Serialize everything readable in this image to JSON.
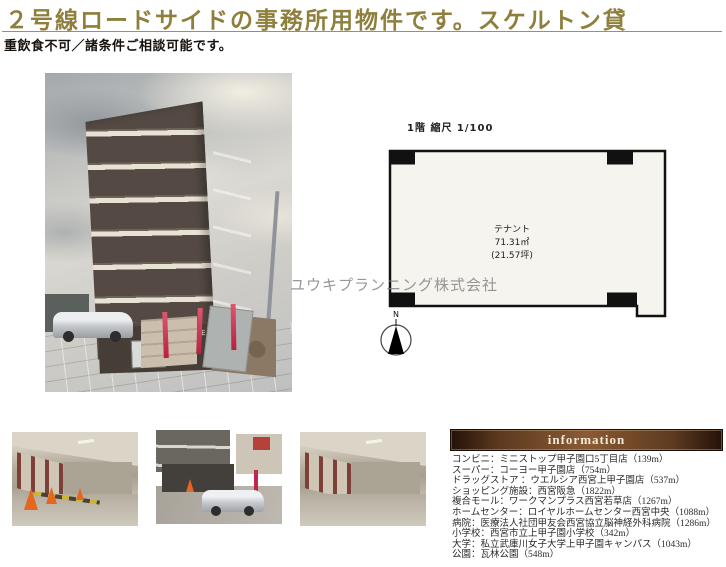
{
  "header": {
    "title": "２号線ロードサイドの事務所用物件です。スケルトン貸",
    "subtitle": "重飲食不可／諸条件ご相談可能です。"
  },
  "floor_plan": {
    "label": "1階 縮尺 1/100",
    "room_name": "テナント",
    "area_sqm": "71.31㎡",
    "area_tsubo": "(21.57坪)",
    "compass_label": "N"
  },
  "photos": {
    "building_sign": "RUSE 918"
  },
  "watermark": "ユウキプランニング株式会社",
  "information": {
    "heading": "information",
    "items": [
      "コンビニ：ミニストップ甲子園口5丁目店（139m）",
      "スーパー：コーヨー甲子園店（754m）",
      "ドラッグストア ：ウエルシア西宮上甲子園店（537m）",
      "ショッピング施設：西宮阪急（1822m）",
      "複合モール：ワークマンプラス西宮若草店（1267m）",
      "ホームセンター：ロイヤルホームセンター西宮中央（1088m）",
      "病院：医療法人社団甲友会西宮協立脳神経外科病院（1286m）",
      "小学校：西宮市立上甲子園小学校（342m）",
      "大学：私立武庫川女子大学上甲子園キャンパス（1043m）",
      "公園：瓦林公園（548m）"
    ]
  },
  "colors": {
    "title_gold": "#8e7f3c",
    "info_bar_dark": "#241208",
    "info_bar_light": "#8a5a33",
    "info_bar_text": "#f2e9d8",
    "plan_fill": "#f5f4ee",
    "watermark_gray": "#7d7d7d"
  }
}
